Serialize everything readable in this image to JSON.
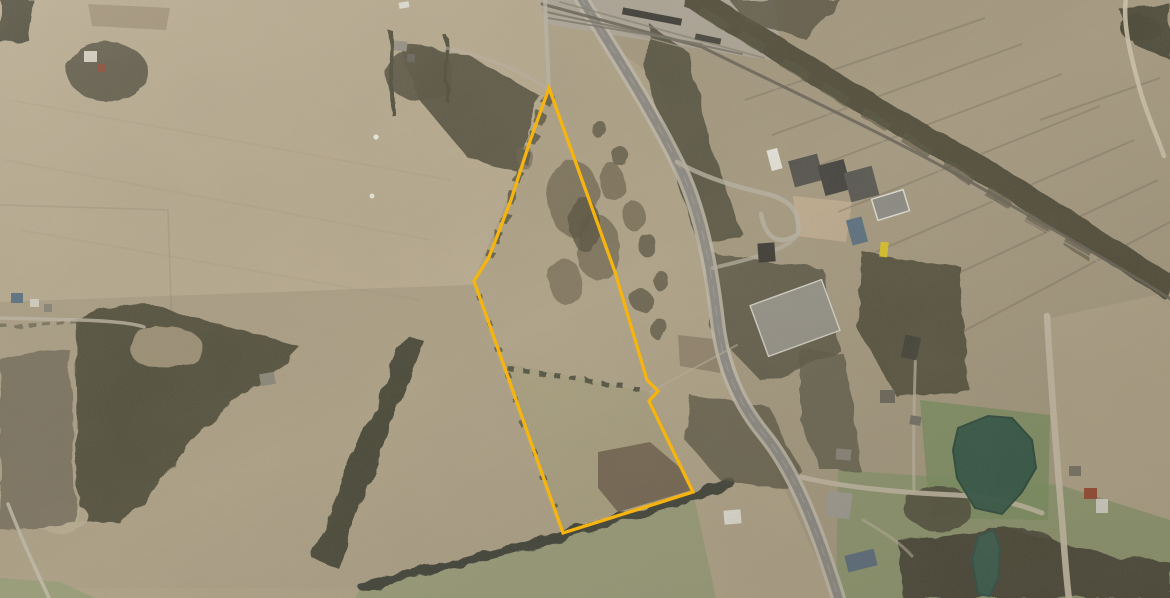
{
  "app": {
    "name": "aerial-parcel-view",
    "description": "Satellite aerial photo of rural farmland with a highlighted property parcel boundary, a highway and railway corridor, school campus, farm buildings and a pond"
  },
  "colors": {
    "boundary": "#F6B40E",
    "field_base": "#b3a78c",
    "forest": "#555240",
    "highway": "#8f8d87",
    "pond": "#35594a"
  },
  "features": {
    "boundary": {
      "name": "parcel-boundary",
      "color": "#F6B40E",
      "width": 3.3,
      "points": "549,88 530,141 511,200 489,257 474,281 563,533 693,492 663,430 649,401 658,391 647,380 615,272"
    },
    "roads": [
      {
        "name": "highway-shoulder",
        "d": "M580,-4 C602,34 644,96 676,160 C700,206 711,264 718,326 C724,372 741,406 763,433 C791,467 813,516 839,600",
        "color": "#c6c0b0",
        "w": 15,
        "op": 0.85
      },
      {
        "name": "highway",
        "d": "M580,-4 C602,34 644,96 676,160 C700,206 711,264 718,326 C724,372 741,406 763,433 C791,467 813,516 839,600",
        "color": "#8f8d87",
        "w": 8.5,
        "op": 1
      },
      {
        "name": "highway-centerline",
        "d": "M580,-4 C602,34 644,96 676,160 C700,206 711,264 718,326 C724,372 741,406 763,433 C791,467 813,516 839,600",
        "color": "#b9b6ac",
        "w": 1,
        "op": 0.45,
        "dash": "10 9"
      },
      {
        "name": "railway",
        "d": "M542,4 C610,22 660,36 702,47 C780,86 900,140 1002,200 C1062,235 1122,268 1172,300",
        "color": "#6b675c",
        "w": 3,
        "op": 0.9
      },
      {
        "name": "railway-bed",
        "d": "M542,9 C610,27 660,41 700,52 C778,91 898,145 1000,205 C1060,240 1120,273 1170,305",
        "color": "#a89f8e",
        "w": 1.3,
        "op": 0.8
      },
      {
        "name": "railyard-track-1",
        "d": "M546,12 L742,54",
        "color": "#7b766a",
        "w": 2,
        "op": 0.85
      },
      {
        "name": "railyard-track-2",
        "d": "M548,18 L702,44",
        "color": "#7b766a",
        "w": 1.8,
        "op": 0.8
      },
      {
        "name": "railyard-track-3",
        "d": "M560,2 L764,58",
        "color": "#8a8577",
        "w": 1.8,
        "op": 0.7
      },
      {
        "name": "east-road",
        "d": "M1047,316 C1051,390 1058,470 1063,532 C1065,562 1067,582 1069,600",
        "color": "#c9c0aa",
        "w": 6.5,
        "op": 0.95
      },
      {
        "name": "south-road",
        "d": "M801,477 C842,487 902,493 956,495 C992,497 1016,503 1042,513",
        "color": "#c5bca7",
        "w": 5,
        "op": 0.9
      },
      {
        "name": "school-driveway",
        "d": "M677,162 C702,176 732,186 763,193 C790,199 801,211 798,234 C780,246 766,240 761,214",
        "color": "#bcb7a7",
        "w": 4.5,
        "op": 0.8
      },
      {
        "name": "school-driveway-2",
        "d": "M713,268 C738,262 762,256 775,250 C786,246 793,241 798,234",
        "color": "#b8b3a3",
        "w": 4,
        "op": 0.75
      },
      {
        "name": "lane-north",
        "d": "M545,-2 C546,30 548,62 549,90",
        "color": "#c2bbab",
        "w": 4,
        "op": 0.8
      },
      {
        "name": "lane-northwest",
        "d": "M549,90 C520,70 484,56 446,48",
        "color": "#bfb8a8",
        "w": 3,
        "op": 0.6
      },
      {
        "name": "west-driveway",
        "d": "M-2,318 L80,320 C112,321 132,323 144,327",
        "color": "#c4bcab",
        "w": 3.5,
        "op": 0.8
      },
      {
        "name": "southwest-lane",
        "d": "M8,504 C22,540 36,570 50,600",
        "color": "#c6bfae",
        "w": 3.5,
        "op": 0.85
      },
      {
        "name": "northeast-track",
        "d": "M1126,-2 C1122,25 1132,60 1140,90 C1148,118 1158,138 1164,156",
        "color": "#cfc6ae",
        "w": 4.5,
        "op": 0.9
      },
      {
        "name": "pond-driveway",
        "d": "M916,344 C914,396 913,442 914,490",
        "color": "#c2baa6",
        "w": 3,
        "op": 0.7
      },
      {
        "name": "lawn-driveway",
        "d": "M863,520 C880,530 900,542 912,556",
        "color": "#bdb5a0",
        "w": 3,
        "op": 0.6
      },
      {
        "name": "field-edge-east",
        "d": "M650,392 L737,345",
        "color": "#c0b7a3",
        "w": 2,
        "op": 0.55
      }
    ],
    "water": [
      {
        "name": "pond",
        "d": "M958,428 L988,416 L1012,418 L1032,440 L1036,468 L1022,492 L1002,514 L975,508 L957,478 L953,450 Z",
        "fill": "#35594a",
        "stroke": "#2b4b3f",
        "op": 0.97
      },
      {
        "name": "pond-small",
        "d": "M978,536 L994,530 L1000,548 L998,578 L990,596 L978,594 L972,560 Z",
        "fill": "#3a6052",
        "stroke": "#31544a",
        "op": 0.95
      }
    ],
    "buildings": [
      {
        "n": "school-annex-white",
        "x": 769,
        "y": 149,
        "w": 11,
        "h": 21,
        "r": -15,
        "f": "#e9e7df"
      },
      {
        "n": "school-block-west",
        "x": 791,
        "y": 157,
        "w": 30,
        "h": 27,
        "r": -15,
        "f": "#55544f"
      },
      {
        "n": "school-block-mid",
        "x": 821,
        "y": 162,
        "w": 27,
        "h": 31,
        "r": -15,
        "f": "#454440"
      },
      {
        "n": "school-block-east",
        "x": 847,
        "y": 169,
        "w": 29,
        "h": 30,
        "r": -15,
        "f": "#5a5954"
      },
      {
        "n": "warehouse-grey",
        "x": 874,
        "y": 194,
        "w": 33,
        "h": 22,
        "r": -17,
        "f": "#8f8f88",
        "s": "#e4e4dc"
      },
      {
        "n": "building-blue",
        "x": 849,
        "y": 218,
        "w": 16,
        "h": 26,
        "r": -15,
        "f": "#5d7384"
      },
      {
        "n": "school-bus-yellow",
        "x": 880,
        "y": 242,
        "w": 8,
        "h": 15,
        "r": 6,
        "f": "#ddc62b"
      },
      {
        "n": "house-dark",
        "x": 758,
        "y": 243,
        "w": 17,
        "h": 19,
        "r": -4,
        "f": "#403f39"
      },
      {
        "n": "warehouse-large",
        "x": 757,
        "y": 291,
        "w": 76,
        "h": 54,
        "r": -20,
        "f": "#98968c",
        "s": "#d8d6cc"
      },
      {
        "n": "house-east-1",
        "x": 903,
        "y": 336,
        "w": 16,
        "h": 23,
        "r": 12,
        "f": "#46443c"
      },
      {
        "n": "house-east-2",
        "x": 880,
        "y": 390,
        "w": 15,
        "h": 13,
        "r": 0,
        "f": "#6e6a5e"
      },
      {
        "n": "house-east-3",
        "x": 836,
        "y": 449,
        "w": 15,
        "h": 11,
        "r": 5,
        "f": "#8b887e"
      },
      {
        "n": "barn-grey",
        "x": 827,
        "y": 492,
        "w": 24,
        "h": 26,
        "r": 8,
        "f": "#a29f96"
      },
      {
        "n": "house-white-roof",
        "x": 724,
        "y": 510,
        "w": 17,
        "h": 14,
        "r": -5,
        "f": "#e6e4da"
      },
      {
        "n": "building-blue-long",
        "x": 846,
        "y": 552,
        "w": 30,
        "h": 17,
        "r": -14,
        "f": "#5e7082"
      },
      {
        "n": "hut-red-roof",
        "x": 1084,
        "y": 488,
        "w": 13,
        "h": 11,
        "r": 0,
        "f": "#9a4a33"
      },
      {
        "n": "house-white-2",
        "x": 1096,
        "y": 499,
        "w": 12,
        "h": 14,
        "r": 0,
        "f": "#d9d7cd"
      },
      {
        "n": "house-east-4",
        "x": 1069,
        "y": 466,
        "w": 12,
        "h": 10,
        "r": 0,
        "f": "#7a7668"
      },
      {
        "n": "pond-shed",
        "x": 910,
        "y": 416,
        "w": 11,
        "h": 9,
        "r": 10,
        "f": "#77746a"
      },
      {
        "n": "farm-west-house",
        "x": 84,
        "y": 51,
        "w": 13,
        "h": 11,
        "r": 0,
        "f": "#dad6c9"
      },
      {
        "n": "farm-west-barn",
        "x": 97,
        "y": 64,
        "w": 9,
        "h": 8,
        "r": 0,
        "f": "#8a4b36"
      },
      {
        "n": "farm-north-house",
        "x": 394,
        "y": 41,
        "w": 13,
        "h": 10,
        "r": 5,
        "f": "#99958a"
      },
      {
        "n": "farm-north-shed",
        "x": 407,
        "y": 54,
        "w": 8,
        "h": 8,
        "r": 5,
        "f": "#6a675e"
      },
      {
        "n": "house-west-blue",
        "x": 11,
        "y": 293,
        "w": 12,
        "h": 10,
        "r": 0,
        "f": "#5d7486"
      },
      {
        "n": "house-west-2",
        "x": 30,
        "y": 299,
        "w": 9,
        "h": 8,
        "r": 0,
        "f": "#d8d5c9"
      },
      {
        "n": "house-west-3",
        "x": 44,
        "y": 304,
        "w": 8,
        "h": 8,
        "r": 0,
        "f": "#8b8779"
      },
      {
        "n": "forest-house",
        "x": 260,
        "y": 373,
        "w": 15,
        "h": 12,
        "r": -10,
        "f": "#8d897c"
      },
      {
        "n": "vehicle-north",
        "x": 399,
        "y": 2,
        "w": 10,
        "h": 6,
        "r": -10,
        "f": "#e8e6de"
      },
      {
        "n": "railcar-long",
        "x": 622,
        "y": 13,
        "w": 60,
        "h": 7,
        "r": 11,
        "f": "#3e3d38"
      },
      {
        "n": "railcar-short",
        "x": 695,
        "y": 36,
        "w": 26,
        "h": 6,
        "r": 12,
        "f": "#474640"
      }
    ],
    "markers": [
      {
        "name": "white-dot-1",
        "cx": 376,
        "cy": 137,
        "r": 2.6,
        "fill": "#f4f2e9"
      },
      {
        "name": "white-dot-2",
        "cx": 372,
        "cy": 196,
        "r": 2.4,
        "fill": "#f4f2e9"
      }
    ]
  }
}
